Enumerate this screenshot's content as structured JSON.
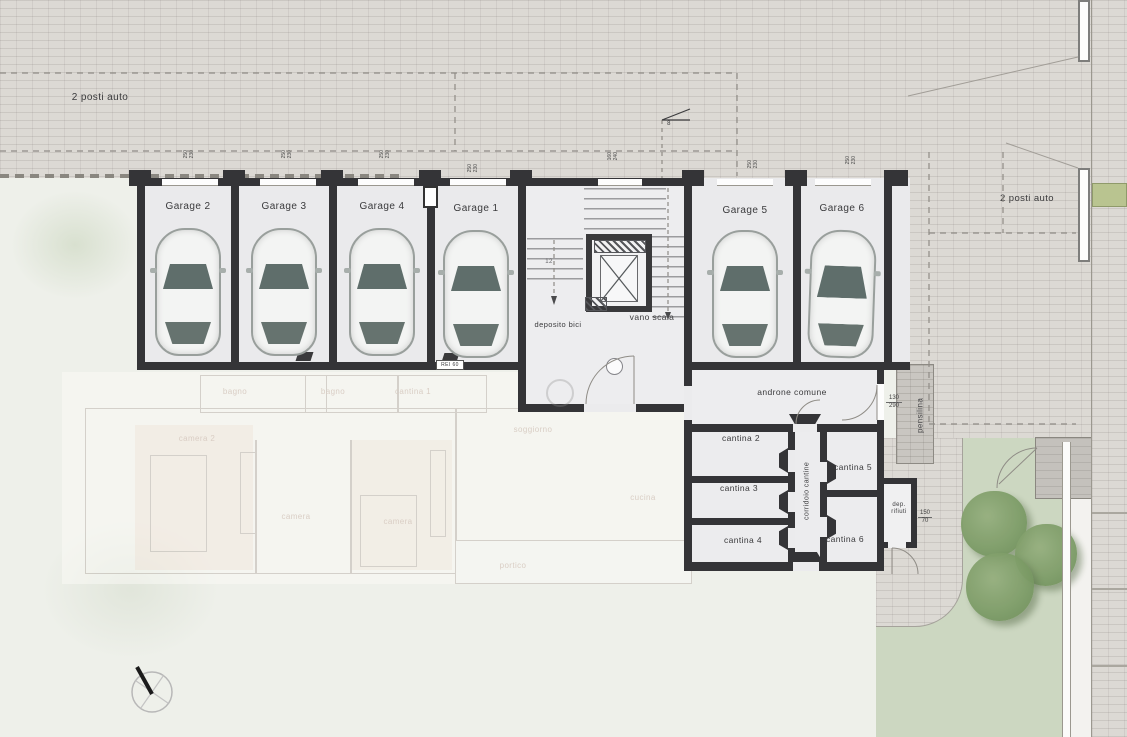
{
  "plan": {
    "parking_left": "2 posti auto",
    "parking_right": "2 posti auto",
    "garages": [
      "Garage 2",
      "Garage 3",
      "Garage 4",
      "Garage 1",
      "Garage 5",
      "Garage 6"
    ],
    "core": {
      "deposito_bici": "deposito bici",
      "vano_scala": "vano scala",
      "stair_steps": "12",
      "level_marker": "8",
      "rei_60": "REI 60"
    },
    "basement": {
      "androne": "androne comune",
      "cantina_2": "cantina 2",
      "cantina_3": "cantina 3",
      "cantina_4": "cantina 4",
      "cantina_5": "cantina 5",
      "cantina_6": "cantina 6",
      "corridoio": "corridoio cantine",
      "dep_rifiuti": "dep. rifiuti",
      "pensilina": "pensilina"
    },
    "faded_floor": {
      "camera_2": "camera 2",
      "bagno_1": "bagno",
      "bagno_2": "bagno",
      "cantina_1": "cantina 1",
      "camera_a": "camera",
      "camera_b": "camera",
      "soggiorno": "soggiorno",
      "cucina": "cucina",
      "portico": "portico"
    },
    "dims": {
      "garage_door": [
        "250",
        "230"
      ],
      "stair_door": [
        "160",
        "240"
      ],
      "entrance": [
        "130",
        "290"
      ],
      "rifiuti": [
        "150",
        "70"
      ]
    },
    "colors": {
      "paving": "#dcd9d4",
      "wall": "#343437",
      "interior": "#eaeaec",
      "lawn": "#ccd7c1",
      "tree": "#7d9c67",
      "hedge": "#b9c490"
    }
  }
}
